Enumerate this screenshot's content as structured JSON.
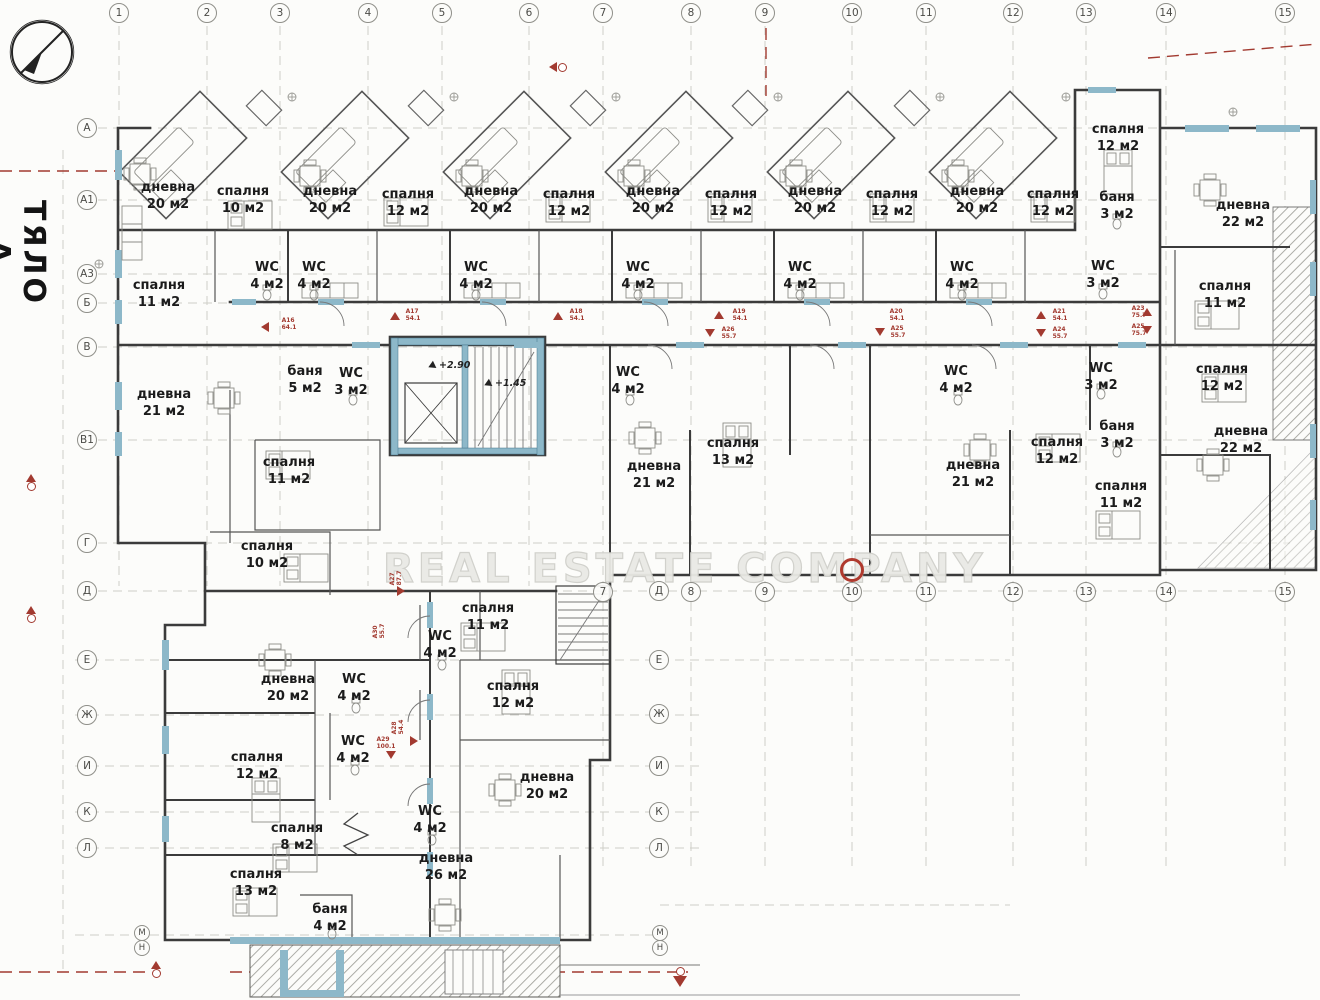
{
  "title": {
    "body": "ТЯЛО А"
  },
  "watermark": {
    "text": "REAL ESTATE COMPANY"
  },
  "palette": {
    "wall": "#3b3b3b",
    "blue": "#8db8c9",
    "red": "#a23a30",
    "grid": "#c6c6c0",
    "furniture": "#8d8d88"
  },
  "grid": {
    "top_columns": [
      {
        "label": "1",
        "x": 119
      },
      {
        "label": "2",
        "x": 207
      },
      {
        "label": "3",
        "x": 280
      },
      {
        "label": "4",
        "x": 368
      },
      {
        "label": "5",
        "x": 442
      },
      {
        "label": "6",
        "x": 529
      },
      {
        "label": "7",
        "x": 603
      },
      {
        "label": "8",
        "x": 691
      },
      {
        "label": "9",
        "x": 765
      },
      {
        "label": "10",
        "x": 852
      },
      {
        "label": "11",
        "x": 926
      },
      {
        "label": "12",
        "x": 1013
      },
      {
        "label": "13",
        "x": 1086
      },
      {
        "label": "14",
        "x": 1166
      },
      {
        "label": "15",
        "x": 1285
      }
    ],
    "mid_columns": [
      {
        "label": "7",
        "x": 603
      },
      {
        "label": "8",
        "x": 691
      },
      {
        "label": "9",
        "x": 765
      },
      {
        "label": "10",
        "x": 852
      },
      {
        "label": "11",
        "x": 926
      },
      {
        "label": "12",
        "x": 1013
      },
      {
        "label": "13",
        "x": 1086
      },
      {
        "label": "14",
        "x": 1166
      },
      {
        "label": "15",
        "x": 1285
      }
    ],
    "left_rows": [
      {
        "label": "А",
        "y": 128
      },
      {
        "label": "А1",
        "y": 200
      },
      {
        "label": "А3",
        "y": 274
      },
      {
        "label": "Б",
        "y": 303
      },
      {
        "label": "В",
        "y": 347
      },
      {
        "label": "В1",
        "y": 440
      },
      {
        "label": "Г",
        "y": 543
      },
      {
        "label": "Д",
        "y": 591
      },
      {
        "label": "Е",
        "y": 660
      },
      {
        "label": "Ж",
        "y": 715
      },
      {
        "label": "И",
        "y": 766
      },
      {
        "label": "К",
        "y": 812
      },
      {
        "label": "Л",
        "y": 848
      }
    ],
    "mid_rows": [
      {
        "label": "Д",
        "x": 659,
        "y": 591
      },
      {
        "label": "Е",
        "x": 659,
        "y": 660
      },
      {
        "label": "Ж",
        "x": 659,
        "y": 714
      },
      {
        "label": "И",
        "x": 659,
        "y": 766
      },
      {
        "label": "К",
        "x": 659,
        "y": 812
      },
      {
        "label": "Л",
        "x": 659,
        "y": 848
      }
    ],
    "small_rows": [
      {
        "label": "М",
        "x": 142,
        "y": 933
      },
      {
        "label": "Н",
        "x": 142,
        "y": 948
      },
      {
        "label": "М",
        "x": 660,
        "y": 933
      },
      {
        "label": "Н",
        "x": 660,
        "y": 948
      }
    ]
  },
  "rooms": [
    {
      "name": "дневна",
      "area": "20 м2",
      "x": 168,
      "y": 197
    },
    {
      "name": "спалня",
      "area": "10 м2",
      "x": 243,
      "y": 201
    },
    {
      "name": "WC",
      "area": "4 м2",
      "x": 267,
      "y": 277
    },
    {
      "name": "спалня",
      "area": "11 м2",
      "x": 159,
      "y": 295
    },
    {
      "name": "дневна",
      "area": "20 м2",
      "x": 330,
      "y": 201
    },
    {
      "name": "спалня",
      "area": "12 м2",
      "x": 408,
      "y": 204
    },
    {
      "name": "WC",
      "area": "4 м2",
      "x": 314,
      "y": 277
    },
    {
      "name": "дневна",
      "area": "20 м2",
      "x": 491,
      "y": 201
    },
    {
      "name": "спалня",
      "area": "12 м2",
      "x": 569,
      "y": 204
    },
    {
      "name": "WC",
      "area": "4 м2",
      "x": 476,
      "y": 277
    },
    {
      "name": "дневна",
      "area": "20 м2",
      "x": 653,
      "y": 201
    },
    {
      "name": "спалня",
      "area": "12 м2",
      "x": 731,
      "y": 204
    },
    {
      "name": "WC",
      "area": "4 м2",
      "x": 638,
      "y": 277
    },
    {
      "name": "дневна",
      "area": "20 м2",
      "x": 815,
      "y": 201
    },
    {
      "name": "спалня",
      "area": "12 м2",
      "x": 892,
      "y": 204
    },
    {
      "name": "WC",
      "area": "4 м2",
      "x": 800,
      "y": 277
    },
    {
      "name": "дневна",
      "area": "20 м2",
      "x": 977,
      "y": 201
    },
    {
      "name": "спалня",
      "area": "12 м2",
      "x": 1053,
      "y": 204
    },
    {
      "name": "WC",
      "area": "4 м2",
      "x": 962,
      "y": 277
    },
    {
      "name": "спалня",
      "area": "12 м2",
      "x": 1118,
      "y": 139
    },
    {
      "name": "баня",
      "area": "3 м2",
      "x": 1117,
      "y": 207
    },
    {
      "name": "WC",
      "area": "3 м2",
      "x": 1103,
      "y": 276
    },
    {
      "name": "дневна",
      "area": "22 м2",
      "x": 1243,
      "y": 215
    },
    {
      "name": "спалня",
      "area": "11 м2",
      "x": 1225,
      "y": 296
    },
    {
      "name": "дневна",
      "area": "21 м2",
      "x": 164,
      "y": 404
    },
    {
      "name": "баня",
      "area": "5 м2",
      "x": 305,
      "y": 381
    },
    {
      "name": "WC",
      "area": "3 м2",
      "x": 351,
      "y": 383
    },
    {
      "name": "спалня",
      "area": "11 м2",
      "x": 289,
      "y": 472
    },
    {
      "name": "спалня",
      "area": "10 м2",
      "x": 267,
      "y": 556
    },
    {
      "name": "WC",
      "area": "4 м2",
      "x": 628,
      "y": 382
    },
    {
      "name": "дневна",
      "area": "21 м2",
      "x": 654,
      "y": 476
    },
    {
      "name": "спалня",
      "area": "13 м2",
      "x": 733,
      "y": 453
    },
    {
      "name": "WC",
      "area": "4 м2",
      "x": 956,
      "y": 381
    },
    {
      "name": "дневна",
      "area": "21 м2",
      "x": 973,
      "y": 475
    },
    {
      "name": "спалня",
      "area": "12 м2",
      "x": 1057,
      "y": 452
    },
    {
      "name": "WC",
      "area": "3 м2",
      "x": 1101,
      "y": 378
    },
    {
      "name": "баня",
      "area": "3 м2",
      "x": 1117,
      "y": 436
    },
    {
      "name": "спалня",
      "area": "11 м2",
      "x": 1121,
      "y": 496
    },
    {
      "name": "спалня",
      "area": "12 м2",
      "x": 1222,
      "y": 379
    },
    {
      "name": "дневна",
      "area": "22 м2",
      "x": 1241,
      "y": 441
    },
    {
      "name": "спалня",
      "area": "11 м2",
      "x": 488,
      "y": 618
    },
    {
      "name": "WC",
      "area": "4 м2",
      "x": 440,
      "y": 646
    },
    {
      "name": "дневна",
      "area": "20 м2",
      "x": 288,
      "y": 689
    },
    {
      "name": "WC",
      "area": "4 м2",
      "x": 354,
      "y": 689
    },
    {
      "name": "спалня",
      "area": "12 м2",
      "x": 513,
      "y": 696
    },
    {
      "name": "спалня",
      "area": "12 м2",
      "x": 257,
      "y": 767
    },
    {
      "name": "WC",
      "area": "4 м2",
      "x": 353,
      "y": 751
    },
    {
      "name": "спалня",
      "area": "8 м2",
      "x": 297,
      "y": 838
    },
    {
      "name": "WC",
      "area": "4 м2",
      "x": 430,
      "y": 821
    },
    {
      "name": "дневна",
      "area": "20 м2",
      "x": 547,
      "y": 787
    },
    {
      "name": "спалня",
      "area": "13 м2",
      "x": 256,
      "y": 884
    },
    {
      "name": "баня",
      "area": "4 м2",
      "x": 330,
      "y": 919
    },
    {
      "name": "дневна",
      "area": "26 м2",
      "x": 446,
      "y": 868
    }
  ],
  "levels": [
    {
      "text": "+2.90",
      "x": 430,
      "y": 360
    },
    {
      "text": "+1.45",
      "x": 486,
      "y": 378
    }
  ],
  "apartment_markers": [
    {
      "code": "A16",
      "area": "64.1",
      "x": 289,
      "y": 325,
      "rot": false
    },
    {
      "code": "A17",
      "area": "54.1",
      "x": 413,
      "y": 316,
      "rot": false
    },
    {
      "code": "A18",
      "area": "54.1",
      "x": 577,
      "y": 316,
      "rot": false
    },
    {
      "code": "A19",
      "area": "54.1",
      "x": 740,
      "y": 316,
      "rot": false
    },
    {
      "code": "A20",
      "area": "54.1",
      "x": 897,
      "y": 316,
      "rot": false
    },
    {
      "code": "A21",
      "area": "54.1",
      "x": 1060,
      "y": 316,
      "rot": false
    },
    {
      "code": "A23",
      "area": "75.7",
      "x": 1139,
      "y": 313,
      "rot": false
    },
    {
      "code": "A25",
      "area": "75.7",
      "x": 1139,
      "y": 331,
      "rot": false
    },
    {
      "code": "A24",
      "area": "55.7",
      "x": 1060,
      "y": 334,
      "rot": false
    },
    {
      "code": "A26",
      "area": "55.7",
      "x": 729,
      "y": 334,
      "rot": false
    },
    {
      "code": "A25",
      "area": "55.7",
      "x": 898,
      "y": 333,
      "rot": false
    },
    {
      "code": "A27",
      "area": "87.7",
      "x": 397,
      "y": 578,
      "rot": true
    },
    {
      "code": "A30",
      "area": "55.7",
      "x": 380,
      "y": 631,
      "rot": true
    },
    {
      "code": "A28",
      "area": "54.4",
      "x": 399,
      "y": 727,
      "rot": true
    },
    {
      "code": "A29",
      "area": "100.1",
      "x": 386,
      "y": 744,
      "rot": false
    }
  ],
  "red_triangles": [
    {
      "x": 266,
      "y": 327,
      "dir": "left"
    },
    {
      "x": 395,
      "y": 317,
      "dir": "up"
    },
    {
      "x": 558,
      "y": 317,
      "dir": "up"
    },
    {
      "x": 719,
      "y": 316,
      "dir": "up"
    },
    {
      "x": 1041,
      "y": 316,
      "dir": "up"
    },
    {
      "x": 1147,
      "y": 313,
      "dir": "up"
    },
    {
      "x": 1147,
      "y": 331,
      "dir": "down"
    },
    {
      "x": 1041,
      "y": 334,
      "dir": "down"
    },
    {
      "x": 880,
      "y": 333,
      "dir": "down"
    },
    {
      "x": 710,
      "y": 334,
      "dir": "down"
    },
    {
      "x": 402,
      "y": 591,
      "dir": "right"
    },
    {
      "x": 415,
      "y": 741,
      "dir": "right"
    },
    {
      "x": 391,
      "y": 756,
      "dir": "down"
    }
  ],
  "section_markers": [
    {
      "x": 33,
      "y": 483,
      "type": "house"
    },
    {
      "x": 33,
      "y": 615,
      "type": "house"
    },
    {
      "x": 158,
      "y": 970,
      "type": "house"
    },
    {
      "x": 680,
      "y": 976,
      "type": "flag-down"
    },
    {
      "x": 556,
      "y": 71,
      "type": "arrow-left"
    }
  ]
}
